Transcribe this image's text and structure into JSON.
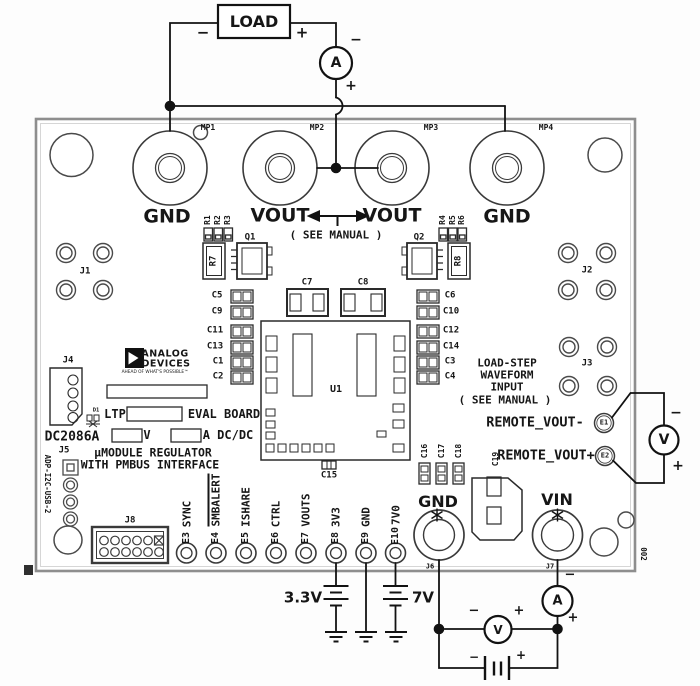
{
  "colors": {
    "wire": "#121212",
    "silkscreen": "#2a2a2a",
    "board_edge": "#8e8e8e",
    "background": "#ffffff",
    "logo_fill": "#111111"
  },
  "labels": [
    {
      "name": "load-box-label",
      "text": "LOAD",
      "x": 254,
      "y": 22,
      "fs": 16,
      "font": "sans"
    },
    {
      "name": "load-minus-sign",
      "text": "−",
      "x": 203,
      "y": 33,
      "fs": 15,
      "font": "sans"
    },
    {
      "name": "load-plus-sign",
      "text": "+",
      "x": 302,
      "y": 33,
      "fs": 15,
      "font": "sans"
    },
    {
      "name": "top-ammeter-label",
      "text": "A",
      "x": 336,
      "y": 63,
      "fs": 14,
      "font": "sans"
    },
    {
      "name": "top-ammeter-minus",
      "text": "−",
      "x": 356,
      "y": 40,
      "fs": 14,
      "font": "sans"
    },
    {
      "name": "top-ammeter-plus",
      "text": "+",
      "x": 351,
      "y": 86,
      "fs": 14,
      "font": "sans"
    },
    {
      "name": "mp1-designator",
      "text": "MP1",
      "x": 208,
      "y": 128,
      "fs": 8
    },
    {
      "name": "mp2-designator",
      "text": "MP2",
      "x": 317,
      "y": 128,
      "fs": 8
    },
    {
      "name": "mp3-designator",
      "text": "MP3",
      "x": 431,
      "y": 128,
      "fs": 8
    },
    {
      "name": "mp4-designator",
      "text": "MP4",
      "x": 546,
      "y": 128,
      "fs": 8
    },
    {
      "name": "mp1-gnd-label",
      "text": "GND",
      "x": 167,
      "y": 217,
      "fs": 19,
      "font": "sans"
    },
    {
      "name": "mp2-vout-label",
      "text": "VOUT",
      "x": 280,
      "y": 216,
      "fs": 19,
      "font": "sans"
    },
    {
      "name": "mp3-vout-label",
      "text": "VOUT",
      "x": 392,
      "y": 216,
      "fs": 19,
      "font": "sans"
    },
    {
      "name": "mp4-gnd-label",
      "text": "GND",
      "x": 507,
      "y": 217,
      "fs": 19,
      "font": "sans"
    },
    {
      "name": "vout-see-manual-note",
      "text": "( SEE MANUAL )",
      "x": 336,
      "y": 235,
      "fs": 11
    },
    {
      "name": "j1-designator",
      "text": "J1",
      "x": 85,
      "y": 272,
      "fs": 9
    },
    {
      "name": "j2-designator",
      "text": "J2",
      "x": 587,
      "y": 271,
      "fs": 9
    },
    {
      "name": "j3-designator",
      "text": "J3",
      "x": 587,
      "y": 364,
      "fs": 9
    },
    {
      "name": "r1-designator",
      "text": "R1",
      "x": 208,
      "y": 220,
      "fs": 8,
      "rot": -90
    },
    {
      "name": "r2-designator",
      "text": "R2",
      "x": 218,
      "y": 220,
      "fs": 8,
      "rot": -90
    },
    {
      "name": "r3-designator",
      "text": "R3",
      "x": 228,
      "y": 220,
      "fs": 8,
      "rot": -90
    },
    {
      "name": "r4-designator",
      "text": "R4",
      "x": 443,
      "y": 220,
      "fs": 8,
      "rot": -90
    },
    {
      "name": "r5-designator",
      "text": "R5",
      "x": 452.5,
      "y": 220,
      "fs": 8,
      "rot": -90
    },
    {
      "name": "r6-designator",
      "text": "R6",
      "x": 462,
      "y": 220,
      "fs": 8,
      "rot": -90
    },
    {
      "name": "q1-designator",
      "text": "Q1",
      "x": 250,
      "y": 238,
      "fs": 9
    },
    {
      "name": "q2-designator",
      "text": "Q2",
      "x": 419,
      "y": 238,
      "fs": 9
    },
    {
      "name": "r7-designator",
      "text": "R7",
      "x": 214,
      "y": 261,
      "fs": 9,
      "rot": -90
    },
    {
      "name": "r8-designator",
      "text": "R8",
      "x": 459,
      "y": 261,
      "fs": 9,
      "rot": -90
    },
    {
      "name": "c5-designator",
      "text": "C5",
      "x": 217,
      "y": 296,
      "fs": 9
    },
    {
      "name": "c9-designator",
      "text": "C9",
      "x": 217,
      "y": 312,
      "fs": 9
    },
    {
      "name": "c11-designator",
      "text": "C11",
      "x": 215,
      "y": 331,
      "fs": 9
    },
    {
      "name": "c13-designator",
      "text": "C13",
      "x": 215,
      "y": 347,
      "fs": 9
    },
    {
      "name": "c1-designator",
      "text": "C1",
      "x": 218,
      "y": 362,
      "fs": 9
    },
    {
      "name": "c2-designator",
      "text": "C2",
      "x": 218,
      "y": 377,
      "fs": 9
    },
    {
      "name": "c6-designator",
      "text": "C6",
      "x": 450,
      "y": 296,
      "fs": 9
    },
    {
      "name": "c10-designator",
      "text": "C10",
      "x": 451,
      "y": 312,
      "fs": 9
    },
    {
      "name": "c12-designator",
      "text": "C12",
      "x": 451,
      "y": 331,
      "fs": 9
    },
    {
      "name": "c14-designator",
      "text": "C14",
      "x": 451,
      "y": 347,
      "fs": 9
    },
    {
      "name": "c3-designator",
      "text": "C3",
      "x": 450,
      "y": 362,
      "fs": 9
    },
    {
      "name": "c4-designator",
      "text": "C4",
      "x": 450,
      "y": 377,
      "fs": 9
    },
    {
      "name": "c7-designator",
      "text": "C7",
      "x": 307,
      "y": 283,
      "fs": 9
    },
    {
      "name": "c8-designator",
      "text": "C8",
      "x": 363,
      "y": 283,
      "fs": 9
    },
    {
      "name": "u1-designator",
      "text": "U1",
      "x": 336,
      "y": 390,
      "fs": 10
    },
    {
      "name": "c15-designator",
      "text": "C15",
      "x": 329,
      "y": 476,
      "fs": 9
    },
    {
      "name": "c16-designator",
      "text": "C16",
      "x": 424.5,
      "y": 451,
      "fs": 8,
      "rot": -90
    },
    {
      "name": "c17-designator",
      "text": "C17",
      "x": 441.5,
      "y": 451,
      "fs": 8,
      "rot": -90
    },
    {
      "name": "c18-designator",
      "text": "C18",
      "x": 458.5,
      "y": 451,
      "fs": 8,
      "rot": -90
    },
    {
      "name": "c19-designator",
      "text": "C19",
      "x": 496,
      "y": 459,
      "fs": 8,
      "rot": -90
    },
    {
      "name": "load-step-line1",
      "text": "LOAD-STEP",
      "x": 507,
      "y": 363,
      "fs": 11
    },
    {
      "name": "load-step-line2",
      "text": "WAVEFORM",
      "x": 507,
      "y": 375,
      "fs": 11
    },
    {
      "name": "load-step-line3",
      "text": "INPUT",
      "x": 507,
      "y": 387,
      "fs": 11
    },
    {
      "name": "load-step-line4",
      "text": "( SEE MANUAL )",
      "x": 505,
      "y": 400,
      "fs": 11
    },
    {
      "name": "remote-vout-minus-label",
      "text": "REMOTE_VOUT-",
      "x": 535,
      "y": 423,
      "fs": 13.5
    },
    {
      "name": "e1-designator",
      "text": "E1",
      "x": 604,
      "y": 423,
      "fs": 7
    },
    {
      "name": "remote-vout-plus-label",
      "text": "REMOTE_VOUT+",
      "x": 546,
      "y": 455.5,
      "fs": 13.5
    },
    {
      "name": "e2-designator",
      "text": "E2",
      "x": 605,
      "y": 456,
      "fs": 7
    },
    {
      "name": "right-voltmeter-label",
      "text": "V",
      "x": 664,
      "y": 440,
      "fs": 14,
      "font": "sans"
    },
    {
      "name": "right-voltmeter-minus",
      "text": "−",
      "x": 676,
      "y": 413,
      "fs": 14,
      "font": "sans"
    },
    {
      "name": "right-voltmeter-plus",
      "text": "+",
      "x": 678,
      "y": 466,
      "fs": 14,
      "font": "sans"
    },
    {
      "name": "j4-designator",
      "text": "J4",
      "x": 68,
      "y": 361,
      "fs": 9
    },
    {
      "name": "adi-logo-analog",
      "text": "ANALOG",
      "x": 165,
      "y": 354,
      "fs": 9.5,
      "font": "sans",
      "ls": 0.5
    },
    {
      "name": "adi-logo-devices",
      "text": "DEVICES",
      "x": 166,
      "y": 363.5,
      "fs": 9.5,
      "font": "sans",
      "ls": 0.5
    },
    {
      "name": "adi-tagline",
      "text": "AHEAD OF WHAT'S POSSIBLE™",
      "x": 155,
      "y": 372.5,
      "fs": 4.3,
      "font": "sans",
      "wt": 400
    },
    {
      "name": "ltp-label",
      "text": "LTP",
      "x": 115,
      "y": 414,
      "fs": 12
    },
    {
      "name": "eval-board-label",
      "text": "EVAL BOARD",
      "x": 224,
      "y": 414,
      "fs": 12
    },
    {
      "name": "volts-suffix-label",
      "text": "V",
      "x": 147,
      "y": 435,
      "fs": 12
    },
    {
      "name": "amps-dcdc-label",
      "text": "A DC/DC",
      "x": 228,
      "y": 435,
      "fs": 12
    },
    {
      "name": "umodule-line1",
      "text": "µMODULE REGULATOR",
      "x": 153,
      "y": 453,
      "fs": 11.5
    },
    {
      "name": "umodule-line2",
      "text": "WITH PMBUS INTERFACE",
      "x": 150,
      "y": 464.5,
      "fs": 11.5
    },
    {
      "name": "board-name",
      "text": "DC2086A",
      "x": 72,
      "y": 437,
      "fs": 13
    },
    {
      "name": "j5-designator",
      "text": "J5",
      "x": 64,
      "y": 451,
      "fs": 9
    },
    {
      "name": "usb-adapter-vertical-label",
      "text": "ADP-I2C-USB-2",
      "x": 47,
      "y": 484,
      "fs": 7.5,
      "rot": 90
    },
    {
      "name": "j8-designator",
      "text": "J8",
      "x": 130,
      "y": 521,
      "fs": 9
    },
    {
      "name": "d1-designator",
      "text": "D1",
      "x": 96,
      "y": 411,
      "fs": 5.5
    },
    {
      "name": "e3-designator",
      "text": "E3",
      "x": 186.5,
      "y": 538,
      "fs": 10,
      "rot": -90
    },
    {
      "name": "e3-signal",
      "text": "SYNC",
      "x": 186.5,
      "y": 514,
      "fs": 11,
      "rot": -90
    },
    {
      "name": "e4-designator",
      "text": "E4",
      "x": 216,
      "y": 538,
      "fs": 10,
      "rot": -90
    },
    {
      "name": "e4-signal",
      "text": "SMBALERT",
      "x": 216,
      "y": 500,
      "fs": 11,
      "rot": -90,
      "ov": true
    },
    {
      "name": "e5-designator",
      "text": "E5",
      "x": 246,
      "y": 538,
      "fs": 10,
      "rot": -90
    },
    {
      "name": "e5-signal",
      "text": "ISHARE",
      "x": 246,
      "y": 507,
      "fs": 11,
      "rot": -90
    },
    {
      "name": "e6-designator",
      "text": "E6",
      "x": 276,
      "y": 538,
      "fs": 10,
      "rot": -90
    },
    {
      "name": "e6-signal",
      "text": "CTRL",
      "x": 276,
      "y": 514,
      "fs": 11,
      "rot": -90
    },
    {
      "name": "e7-designator",
      "text": "E7",
      "x": 306,
      "y": 538,
      "fs": 10,
      "rot": -90
    },
    {
      "name": "e7-signal",
      "text": "VOUTS",
      "x": 306,
      "y": 510,
      "fs": 11,
      "rot": -90
    },
    {
      "name": "e8-designator",
      "text": "E8",
      "x": 336,
      "y": 538,
      "fs": 10,
      "rot": -90
    },
    {
      "name": "e8-signal",
      "text": "3V3",
      "x": 336,
      "y": 517,
      "fs": 11,
      "rot": -90
    },
    {
      "name": "e9-designator",
      "text": "E9",
      "x": 366,
      "y": 538,
      "fs": 10,
      "rot": -90
    },
    {
      "name": "e9-signal",
      "text": "GND",
      "x": 366,
      "y": 517,
      "fs": 11,
      "rot": -90
    },
    {
      "name": "e10-designator",
      "text": "E10",
      "x": 395.5,
      "y": 536,
      "fs": 10,
      "rot": -90
    },
    {
      "name": "e10-signal",
      "text": "7V0",
      "x": 395.5,
      "y": 515,
      "fs": 11,
      "rot": -90
    },
    {
      "name": "j6-gnd-label",
      "text": "GND",
      "x": 438,
      "y": 502,
      "fs": 16,
      "font": "sans"
    },
    {
      "name": "j7-vin-label",
      "text": "VIN",
      "x": 557,
      "y": 500,
      "fs": 16,
      "font": "sans"
    },
    {
      "name": "j6-designator",
      "text": "J6",
      "x": 430,
      "y": 567,
      "fs": 7
    },
    {
      "name": "j7-designator",
      "text": "J7",
      "x": 550,
      "y": 567,
      "fs": 7
    },
    {
      "name": "supply-3v3-label",
      "text": "3.3V",
      "x": 303,
      "y": 598,
      "fs": 15,
      "font": "sans"
    },
    {
      "name": "supply-7v-label",
      "text": "7V",
      "x": 423,
      "y": 598,
      "fs": 15,
      "font": "sans"
    },
    {
      "name": "bottom-voltmeter-label",
      "text": "V",
      "x": 498,
      "y": 630,
      "fs": 12,
      "font": "sans"
    },
    {
      "name": "bottom-voltmeter-minus",
      "text": "−",
      "x": 474,
      "y": 611,
      "fs": 13,
      "font": "sans"
    },
    {
      "name": "bottom-voltmeter-plus",
      "text": "+",
      "x": 519,
      "y": 611,
      "fs": 13,
      "font": "sans"
    },
    {
      "name": "bottom-ammeter-label",
      "text": "A",
      "x": 557.5,
      "y": 601,
      "fs": 13,
      "font": "sans"
    },
    {
      "name": "bottom-ammeter-minus",
      "text": "−",
      "x": 570,
      "y": 575,
      "fs": 13,
      "font": "sans"
    },
    {
      "name": "bottom-ammeter-plus",
      "text": "+",
      "x": 573,
      "y": 618,
      "fs": 13,
      "font": "sans"
    },
    {
      "name": "battery-minus",
      "text": "−",
      "x": 474,
      "y": 657,
      "fs": 12,
      "font": "sans"
    },
    {
      "name": "battery-plus",
      "text": "+",
      "x": 521,
      "y": 655,
      "fs": 12,
      "font": "sans"
    },
    {
      "name": "board-serial",
      "text": "002",
      "x": 643,
      "y": 554,
      "fs": 7.5,
      "rot": 90
    }
  ]
}
